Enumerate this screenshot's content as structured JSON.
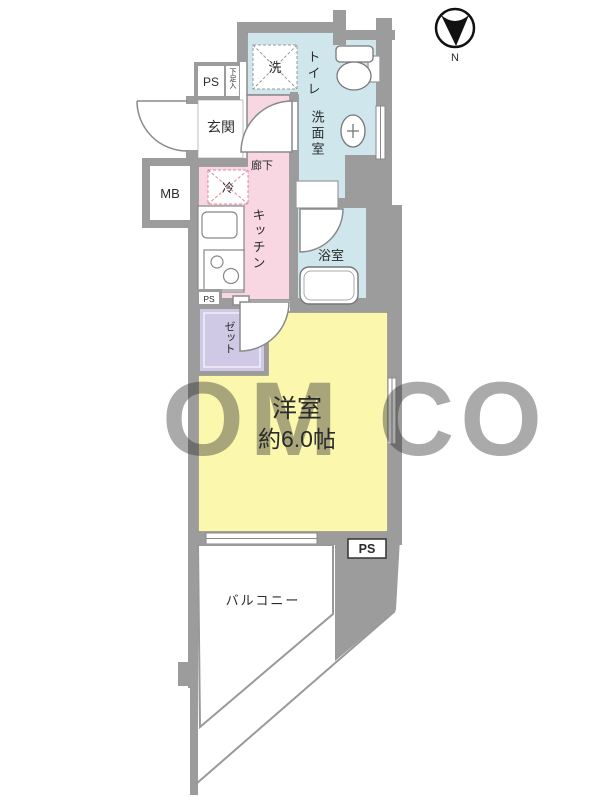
{
  "labels": {
    "ps": "PS",
    "mb": "MB",
    "shoe": "下足入",
    "washer": "洗",
    "fridge": "冷",
    "north": "N"
  },
  "rooms": {
    "entrance": "玄関",
    "hallway": "廊下",
    "kitchen": "キッチン",
    "toilet": "トイレ",
    "washroom": "洗面室",
    "bathroom": "浴室",
    "closet1": "クロー",
    "closet2": "ゼット",
    "bedroom": "洋室",
    "bedroom_size": "約6.0帖",
    "balcony": "バルコニー"
  },
  "watermark": "OM CO",
  "colors": {
    "wall": "#9c9c9c",
    "water": "#cfe7ec",
    "kitchen": "#f8d6e2",
    "bedroom": "#fbf7ad",
    "closet": "#cfc9e6"
  }
}
